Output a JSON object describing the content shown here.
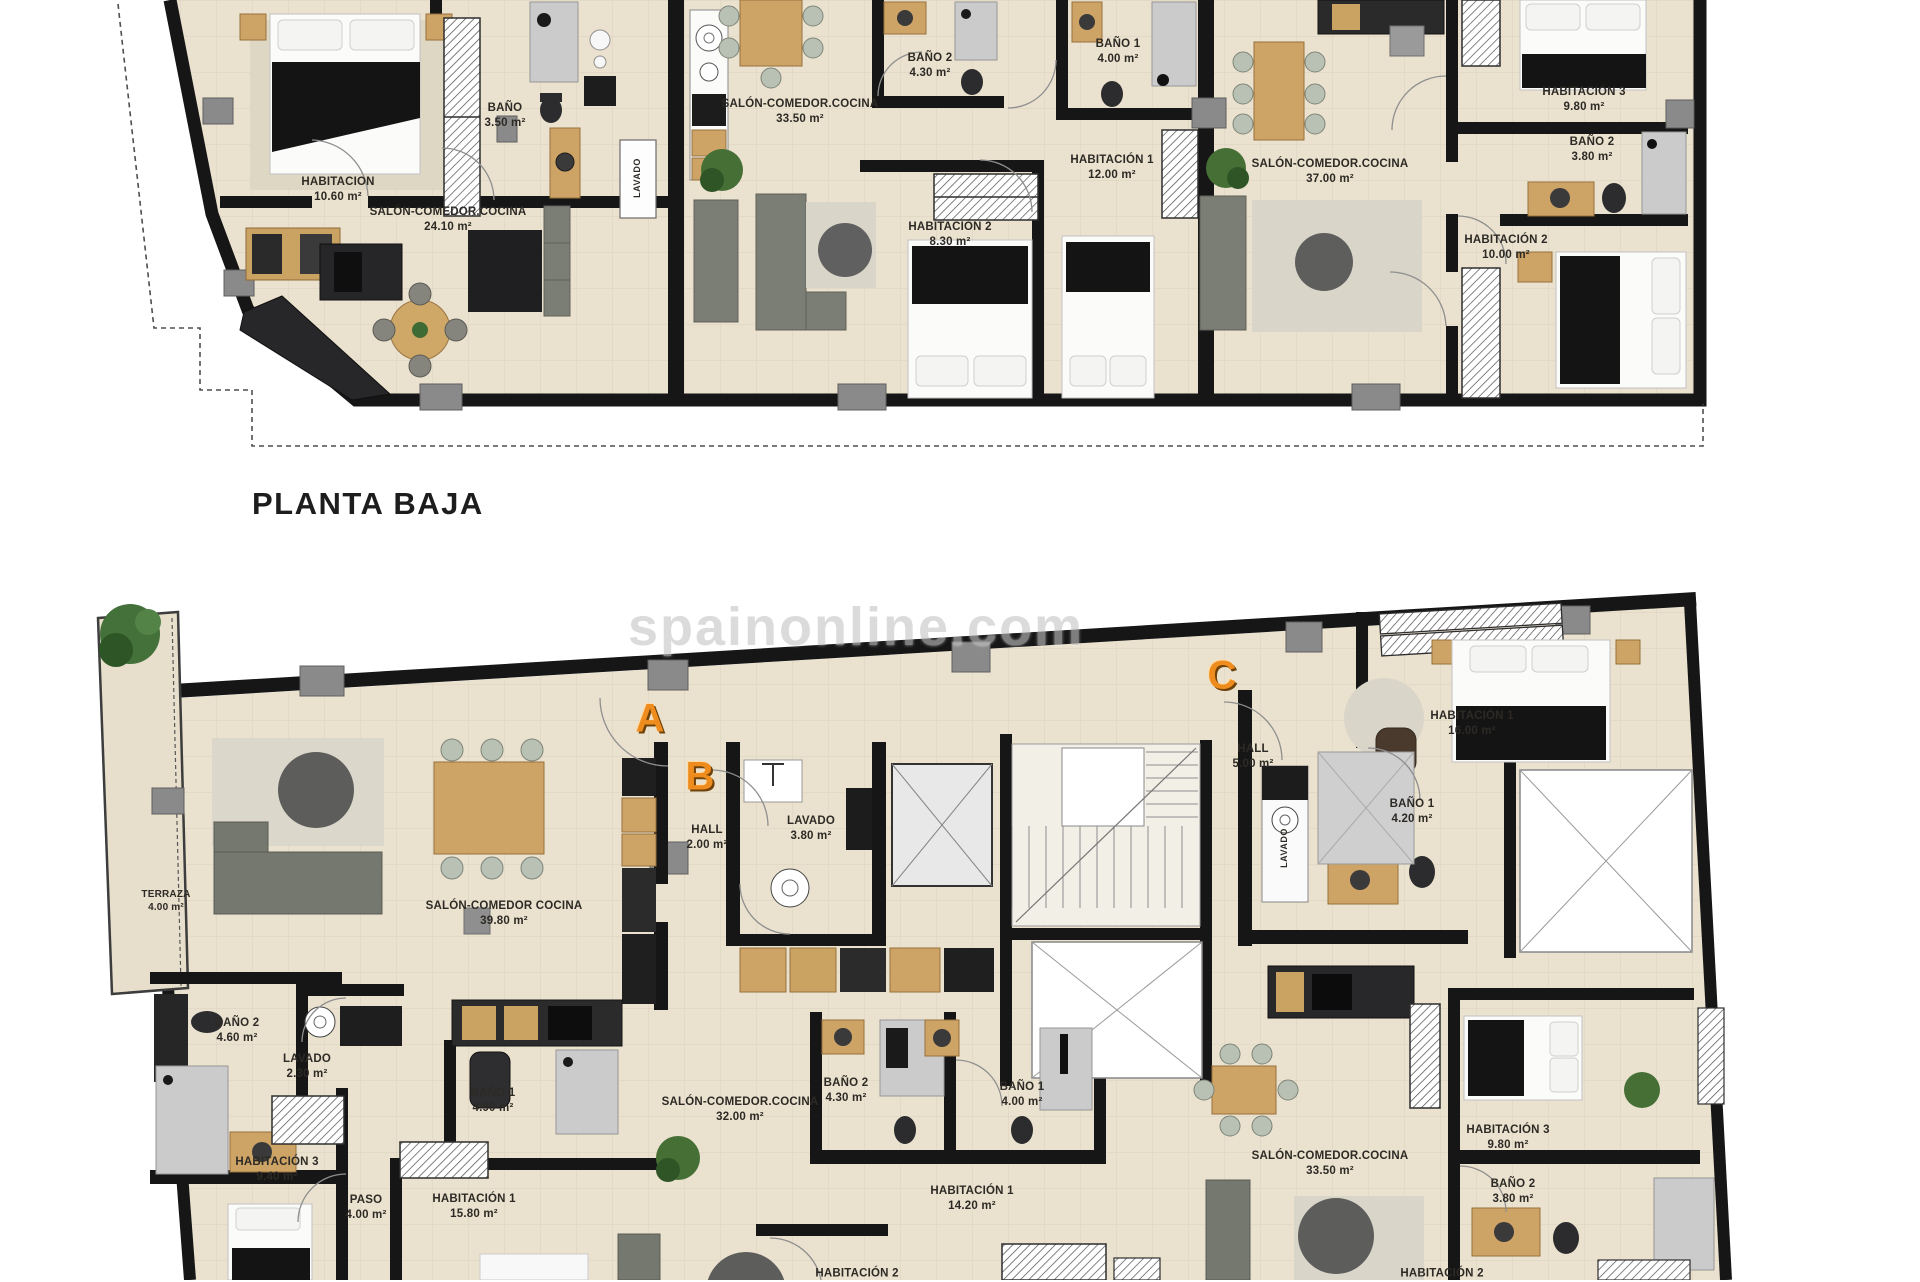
{
  "page": {
    "floor_title": "PLANTA BAJA",
    "watermark": "spainonline.com"
  },
  "colors": {
    "wall": "#161616",
    "floor": "#eae2cf",
    "accent_orange": "#ee8c1e",
    "shower_gray": "#cbcbcb",
    "wood": "#cda466"
  },
  "floor0": {
    "title": "PLANTA BAJA",
    "rooms": [
      {
        "label": "HABITACION",
        "area": "10.60 m²",
        "x": 338,
        "y": 190
      },
      {
        "label": "BAÑO",
        "area": "3.50 m²",
        "x": 505,
        "y": 116
      },
      {
        "label": "LAVADO",
        "area": "",
        "x": 638,
        "y": 178,
        "rot": true
      },
      {
        "label": "SALÓN-COMEDOR.COCINA",
        "area": "24.10 m²",
        "x": 448,
        "y": 220
      },
      {
        "label": "SALÓN-COMEDOR.COCINA",
        "area": "33.50 m²",
        "x": 800,
        "y": 112
      },
      {
        "label": "BAÑO 2",
        "area": "4.30 m²",
        "x": 930,
        "y": 66
      },
      {
        "label": "BAÑO 1",
        "area": "4.00 m²",
        "x": 1118,
        "y": 52
      },
      {
        "label": "HABITACIÓN 1",
        "area": "12.00 m²",
        "x": 1112,
        "y": 168
      },
      {
        "label": "HABITACIÓN 2",
        "area": "8.30 m²",
        "x": 950,
        "y": 235
      },
      {
        "label": "SALÓN-COMEDOR.COCINA",
        "area": "37.00 m²",
        "x": 1330,
        "y": 172
      },
      {
        "label": "HABITACIÓN 3",
        "area": "9.80 m²",
        "x": 1584,
        "y": 100
      },
      {
        "label": "BAÑO 2",
        "area": "3.80 m²",
        "x": 1592,
        "y": 150
      },
      {
        "label": "HABITACIÓN 2",
        "area": "10.00 m²",
        "x": 1506,
        "y": 248
      }
    ]
  },
  "floor1": {
    "letters": [
      {
        "label": "A",
        "x": 650,
        "y": 719
      },
      {
        "label": "B",
        "x": 700,
        "y": 777
      },
      {
        "label": "C",
        "x": 1222,
        "y": 676
      }
    ],
    "rooms": [
      {
        "label": "TERRAZA",
        "area": "4.00 m²",
        "x": 166,
        "y": 901,
        "small": true
      },
      {
        "label": "SALÓN-COMEDOR COCINA",
        "area": "39.80 m²",
        "x": 504,
        "y": 914
      },
      {
        "label": "HALL",
        "area": "2.00 m²",
        "x": 707,
        "y": 838
      },
      {
        "label": "LAVADO",
        "area": "3.80 m²",
        "x": 811,
        "y": 829
      },
      {
        "label": "HALL",
        "area": "5.00 m²",
        "x": 1253,
        "y": 757
      },
      {
        "label": "HABITACIÓN 1",
        "area": "16.00 m²",
        "x": 1472,
        "y": 724
      },
      {
        "label": "BAÑO 1",
        "area": "4.20 m²",
        "x": 1412,
        "y": 812
      },
      {
        "label": "LAVADO",
        "area": "",
        "x": 1285,
        "y": 848,
        "rot": true
      },
      {
        "label": "BAÑO 2",
        "area": "4.60 m²",
        "x": 237,
        "y": 1031
      },
      {
        "label": "LAVADO",
        "area": "2.30 m²",
        "x": 307,
        "y": 1067
      },
      {
        "label": "HABITACIÓN 3",
        "area": "9.40 m²",
        "x": 277,
        "y": 1170
      },
      {
        "label": "PASO",
        "area": "4.00 m²",
        "x": 366,
        "y": 1208
      },
      {
        "label": "BAÑO 1",
        "area": "4.90 m²",
        "x": 493,
        "y": 1101
      },
      {
        "label": "HABITACIÓN 1",
        "area": "15.80 m²",
        "x": 474,
        "y": 1207
      },
      {
        "label": "SALÓN-COMEDOR.COCINA",
        "area": "32.00 m²",
        "x": 740,
        "y": 1110
      },
      {
        "label": "BAÑO 2",
        "area": "4.30 m²",
        "x": 846,
        "y": 1091
      },
      {
        "label": "BAÑO 1",
        "area": "4.00 m²",
        "x": 1022,
        "y": 1095
      },
      {
        "label": "HABITACIÓN 1",
        "area": "14.20 m²",
        "x": 972,
        "y": 1199
      },
      {
        "label": "HABITACIÓN 2",
        "area": "",
        "x": 857,
        "y": 1274
      },
      {
        "label": "SALÓN-COMEDOR.COCINA",
        "area": "33.50 m²",
        "x": 1330,
        "y": 1164
      },
      {
        "label": "HABITACIÓN 3",
        "area": "9.80 m²",
        "x": 1508,
        "y": 1138
      },
      {
        "label": "BAÑO 2",
        "area": "3.80 m²",
        "x": 1513,
        "y": 1192
      },
      {
        "label": "HABITACIÓN 2",
        "area": "",
        "x": 1442,
        "y": 1274
      }
    ]
  }
}
